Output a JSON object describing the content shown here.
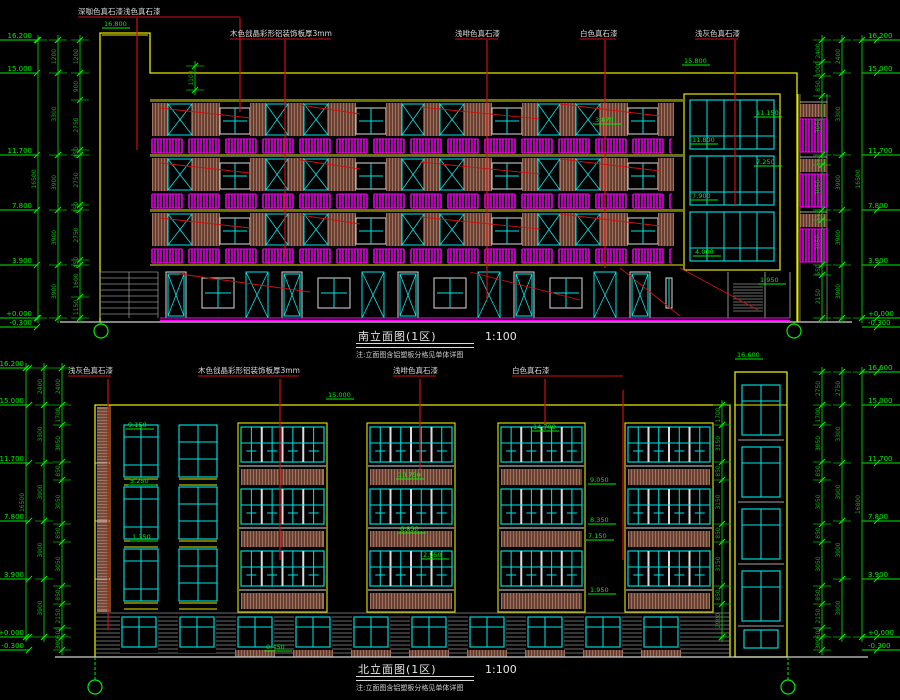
{
  "colors": {
    "background": "#000000",
    "dimension_green": "#00bb00",
    "level_green": "#00ee00",
    "outline_yellow": "#e8e800",
    "window_cyan": "#00e8e8",
    "railing_magenta": "#ff00ff",
    "leader_red": "#cf1010",
    "wood_brown": "#a3705c",
    "wood_gap": "#2b150d",
    "text_white": "#dcdcdc",
    "ground_gray": "#909090"
  },
  "south": {
    "title": "南立面图(1区)",
    "scale": "1:100",
    "note": "注:立面图含铝塑板分格见单体详图",
    "annotations": [
      {
        "text": "深咖色真石漆浅色真石漆",
        "x": 78,
        "y": 14,
        "leaders": [
          [
            137,
            18,
            150
          ],
          [
            240,
            18,
            112
          ]
        ]
      },
      {
        "text": "木色戗晶彩形铝装饰板厚3mm",
        "x": 230,
        "y": 36,
        "leaders": [
          [
            285,
            40,
            258
          ]
        ]
      },
      {
        "text": "浅啡色真石漆",
        "x": 455,
        "y": 36,
        "leaders": [
          [
            487,
            40,
            300
          ]
        ]
      },
      {
        "text": "白色真石漆",
        "x": 580,
        "y": 36,
        "leaders": [
          [
            605,
            40,
            268
          ]
        ]
      },
      {
        "text": "浅灰色真石漆",
        "x": 695,
        "y": 36,
        "leaders": [
          [
            735,
            40,
            205
          ]
        ]
      }
    ],
    "levels_left": [
      [
        "16.200",
        40
      ],
      [
        "15.000",
        73
      ],
      [
        "11.700",
        155
      ],
      [
        "7.800",
        210
      ],
      [
        "3.900",
        265
      ],
      [
        "+0.000",
        318
      ],
      [
        "-0.300",
        327
      ]
    ],
    "levels_right": [
      [
        "16.200",
        40
      ],
      [
        "15.000",
        73
      ],
      [
        "11.700",
        155
      ],
      [
        "7.800",
        210
      ],
      [
        "3.900",
        265
      ],
      [
        "+0.000",
        318
      ],
      [
        "-0.300",
        327
      ]
    ],
    "marks": [
      [
        "16.800",
        104,
        26
      ],
      [
        "15.800",
        684,
        63
      ],
      [
        "11.800",
        692,
        142
      ],
      [
        "7.900",
        692,
        198
      ],
      [
        "4.000",
        695,
        254
      ],
      [
        "11.150",
        756,
        115
      ],
      [
        "7.250",
        756,
        164
      ],
      [
        "3.870",
        595,
        122
      ],
      [
        "1.950",
        760,
        282
      ]
    ],
    "chains": [
      {
        "x": 80,
        "ys": [
          40,
          73,
          100,
          150,
          155,
          205,
          210,
          260,
          265,
          297,
          318
        ],
        "labels": [
          "1200",
          "900",
          "2750",
          "450",
          "2750",
          "450",
          "2750",
          "450",
          "1600",
          "1150"
        ]
      },
      {
        "x": 58,
        "ys": [
          40,
          73,
          155,
          210,
          265,
          318
        ],
        "labels": [
          "1200",
          "3300",
          "3900",
          "3900",
          "3900"
        ]
      },
      {
        "x": 38,
        "ys": [
          40,
          318
        ],
        "labels": [
          "16500"
        ]
      },
      {
        "x": 822,
        "ys": [
          40,
          62,
          76,
          96,
          155,
          165,
          210,
          220,
          265,
          275,
          318
        ],
        "labels": [
          "2400",
          "1000",
          "850",
          "3050",
          "650",
          "3050",
          "650",
          "3050",
          "650",
          "2150"
        ]
      },
      {
        "x": 842,
        "ys": [
          40,
          73,
          155,
          210,
          265,
          318
        ],
        "labels": [
          "2400",
          "3300",
          "3900",
          "3900",
          "3900"
        ]
      },
      {
        "x": 862,
        "ys": [
          40,
          318
        ],
        "labels": [
          "16500"
        ]
      },
      {
        "x": 195,
        "ys": [
          66,
          90
        ],
        "labels": [
          "1100"
        ]
      }
    ]
  },
  "north": {
    "title": "北立面图(1区)",
    "scale": "1:100",
    "note": "注:立面图含铝塑板分格见单体详图",
    "annotations": [
      {
        "text": "浅灰色真石漆",
        "x": 68,
        "y": 373,
        "leaders": [
          [
            108,
            379,
            630
          ]
        ]
      },
      {
        "text": "木色戗晶彩形铝装饰板厚3mm",
        "x": 198,
        "y": 373,
        "leaders": [
          [
            280,
            379,
            560
          ]
        ]
      },
      {
        "text": "浅啡色真石漆",
        "x": 393,
        "y": 373,
        "leaders": [
          [
            420,
            379,
            470
          ]
        ]
      },
      {
        "text": "白色真石漆",
        "x": 512,
        "y": 373,
        "leaders": [
          [
            545,
            379,
            430
          ],
          [
            623,
            390,
            560
          ]
        ]
      }
    ],
    "levels_left": [
      [
        "16.200",
        368
      ],
      [
        "15.000",
        405
      ],
      [
        "11.700",
        463
      ],
      [
        "7.800",
        521
      ],
      [
        "3.900",
        579
      ],
      [
        "+0.000",
        637
      ],
      [
        "-0.300",
        650
      ]
    ],
    "levels_right": [
      [
        "16.600",
        372
      ],
      [
        "15.000",
        405
      ],
      [
        "11.700",
        463
      ],
      [
        "7.800",
        521
      ],
      [
        "3.900",
        579
      ],
      [
        "+0.000",
        637
      ],
      [
        "-0.300",
        650
      ]
    ],
    "marks": [
      [
        "15.000",
        328,
        397
      ],
      [
        "16.600",
        737,
        357
      ],
      [
        "9.150",
        128,
        427
      ],
      [
        "5.250",
        130,
        483
      ],
      [
        "1.350",
        132,
        539
      ],
      [
        "14.700",
        533,
        429
      ],
      [
        "10.750",
        398,
        477
      ],
      [
        "6.850",
        400,
        531
      ],
      [
        "2.950",
        423,
        557
      ],
      [
        "9.050",
        590,
        482
      ],
      [
        "8.350",
        590,
        522
      ],
      [
        "7.150",
        588,
        538
      ],
      [
        "1.950",
        590,
        592
      ],
      [
        "0.450",
        266,
        649
      ]
    ],
    "chains": [
      {
        "x": 62,
        "ys": [
          368,
          405,
          425,
          462,
          480,
          524,
          542,
          586,
          604,
          628,
          637,
          650
        ],
        "labels": [
          "2400",
          "1700",
          "3050",
          "850",
          "3050",
          "850",
          "3050",
          "850",
          "2150",
          "600",
          "300"
        ]
      },
      {
        "x": 44,
        "ys": [
          368,
          405,
          463,
          521,
          579,
          637
        ],
        "labels": [
          "2400",
          "3300",
          "3900",
          "3900",
          "3900"
        ]
      },
      {
        "x": 26,
        "ys": [
          368,
          637
        ],
        "labels": [
          "16500"
        ]
      },
      {
        "x": 722,
        "ys": [
          405,
          425,
          462,
          480,
          524,
          542,
          586,
          604,
          637
        ],
        "labels": [
          "1700",
          "3150",
          "850",
          "3150",
          "850",
          "3150",
          "850",
          "2900"
        ]
      },
      {
        "x": 822,
        "ys": [
          372,
          405,
          425,
          462,
          480,
          524,
          542,
          586,
          604,
          628,
          637,
          650
        ],
        "labels": [
          "2750",
          "1700",
          "3050",
          "850",
          "3050",
          "850",
          "3050",
          "850",
          "2150",
          "600",
          "300"
        ]
      },
      {
        "x": 842,
        "ys": [
          372,
          405,
          463,
          521,
          579,
          637
        ],
        "labels": [
          "2750",
          "3300",
          "3900",
          "3900",
          "3900"
        ]
      },
      {
        "x": 862,
        "ys": [
          372,
          637
        ],
        "labels": [
          "16800"
        ]
      }
    ]
  }
}
